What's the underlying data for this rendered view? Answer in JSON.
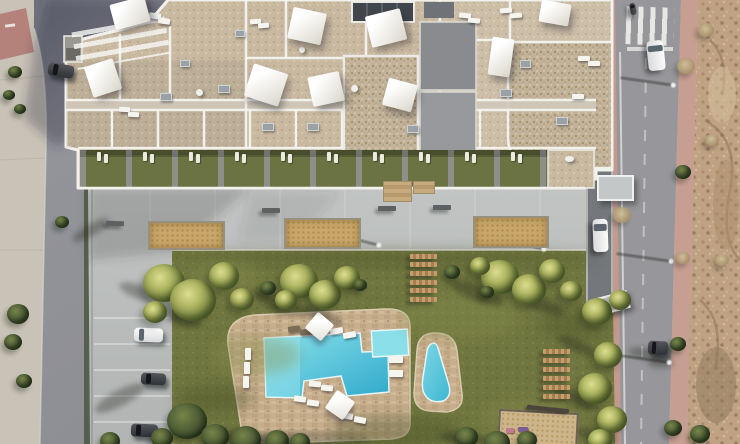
{
  "scene": {
    "subject": "aerial-top-down-render-of-residential-complex-with-roof-terraces-pool-and-garden",
    "palette": {
      "pavement": "#c9c3b7",
      "street_asphalt": "#8d8e94",
      "road_asphalt": "#97979b",
      "esplanade": "#bcbfbe",
      "lawn": "#70763f",
      "roof_gravel": "#c9b9a1",
      "pool_deck_stone": "#c7ae8d",
      "water_deep": "#2fa9cb",
      "water_light": "#8ce2ec",
      "sidewalk_pink": "#c49a8e",
      "dirt_lot": "#bfa284",
      "parapet_white": "#f2f1ec",
      "garden_green": "#6c7342",
      "driveway_gray": "#74777b",
      "sand": "#c8a76c",
      "wood": "#a67f4e",
      "hedge": "#55614a",
      "shade_sail_white": "#ffffff"
    }
  },
  "names": {
    "sail": "shade-sail",
    "umbrella": "parasol",
    "lounger_w": "sun-lounger",
    "lounger_vw": "sun-lounger",
    "lounger_d": "sun-lounger-dark",
    "lounger_v": "garden-lounger",
    "tree_palm": "palm-tree",
    "tree_bush": "shrub",
    "tree_dry": "dry-shrub",
    "shadow": "cast-shadow",
    "shline": "lamp-post-shadow",
    "bench": "bench",
    "sandbox": "planter-sandbox",
    "plank": "wooden-step-plank",
    "car_w": "white-car",
    "car_d": "dark-car",
    "table": "terrace-table",
    "ac": "ac-unit",
    "mat": "entrance-mat",
    "canopy": "entrance-canopy",
    "xwalk_h": "pedestrian-crossing",
    "xwalk_v": "pedestrian-crossing",
    "patch_l": "grass-light-patch",
    "patch_d": "grass-dark-patch",
    "playpit": "playground-sandpit",
    "beam": "playground-beam",
    "playitem_pink": "play-equipment",
    "playitem_purple": "play-equipment"
  },
  "objects": {
    "patch_d": [
      [
        330,
        415,
        130,
        35,
        0
      ],
      [
        175,
        385,
        80,
        28,
        0
      ],
      [
        540,
        310,
        70,
        30,
        0
      ],
      [
        180,
        250,
        420,
        16,
        0
      ]
    ],
    "patch_l": [
      [
        210,
        335,
        90,
        40,
        0
      ],
      [
        400,
        295,
        120,
        45,
        0
      ],
      [
        480,
        400,
        90,
        35,
        0
      ],
      [
        190,
        260,
        70,
        30,
        0
      ]
    ],
    "shadow": [
      [
        118,
        286,
        48,
        14,
        20
      ],
      [
        150,
        308,
        52,
        15,
        20
      ],
      [
        250,
        295,
        58,
        16,
        22
      ],
      [
        300,
        310,
        44,
        13,
        22
      ],
      [
        448,
        285,
        58,
        16,
        22
      ],
      [
        520,
        298,
        46,
        14,
        22
      ],
      [
        556,
        340,
        42,
        12,
        24
      ],
      [
        552,
        392,
        46,
        13,
        24
      ],
      [
        70,
        224,
        42,
        12,
        -30
      ],
      [
        92,
        390,
        56,
        16,
        -28
      ],
      [
        628,
        348,
        40,
        12,
        10
      ],
      [
        214,
        430,
        50,
        14,
        5
      ],
      [
        440,
        432,
        46,
        12,
        5
      ],
      [
        250,
        436,
        60,
        14,
        3
      ],
      [
        575,
        430,
        44,
        12,
        15
      ],
      [
        648,
        358,
        26,
        10,
        0
      ]
    ],
    "shline": [
      [
        332,
        238,
        48,
        3,
        14
      ],
      [
        497,
        242,
        48,
        3,
        14
      ],
      [
        620,
        80,
        54,
        3,
        8
      ],
      [
        616,
        256,
        56,
        3,
        8
      ],
      [
        612,
        357,
        58,
        3,
        8
      ]
    ],
    "sandbox": [
      [
        148,
        221,
        73,
        25,
        0
      ],
      [
        284,
        218,
        73,
        27,
        0
      ],
      [
        473,
        216,
        72,
        28,
        0
      ]
    ],
    "mat": [
      [
        383,
        181,
        27,
        19,
        0
      ],
      [
        413,
        181,
        20,
        11,
        0
      ]
    ],
    "bench": [
      [
        106,
        221,
        18,
        5,
        2
      ],
      [
        262,
        208,
        18,
        5,
        0
      ],
      [
        378,
        206,
        18,
        5,
        0
      ],
      [
        433,
        205,
        18,
        5,
        0
      ]
    ],
    "plank": [
      [
        410,
        254,
        27,
        5,
        0
      ],
      [
        410,
        262,
        27,
        5,
        0
      ],
      [
        410,
        271,
        27,
        5,
        0
      ],
      [
        410,
        280,
        27,
        5,
        0
      ],
      [
        410,
        288,
        27,
        5,
        0
      ],
      [
        410,
        297,
        27,
        5,
        0
      ],
      [
        543,
        349,
        27,
        5,
        0
      ],
      [
        543,
        358,
        27,
        5,
        0
      ],
      [
        543,
        367,
        27,
        5,
        0
      ],
      [
        543,
        376,
        27,
        5,
        0
      ],
      [
        543,
        385,
        27,
        5,
        0
      ],
      [
        543,
        394,
        27,
        5,
        0
      ]
    ],
    "playpit": [
      [
        498,
        411,
        76,
        33,
        3
      ]
    ],
    "beam": [
      [
        527,
        407,
        42,
        4,
        6
      ]
    ],
    "playitem_pink": [
      [
        506,
        428,
        8,
        5,
        0
      ]
    ],
    "playitem_purple": [
      [
        518,
        427,
        10,
        5,
        0
      ]
    ],
    "xwalk_h": [
      [
        74,
        24,
        94,
        38,
        -10
      ]
    ],
    "xwalk_v": [
      [
        626,
        7,
        48,
        38,
        2
      ]
    ],
    "car_w": [
      [
        134,
        328,
        29,
        14,
        2
      ],
      [
        584,
        228,
        33,
        15,
        88
      ],
      [
        641,
        47,
        30,
        17,
        84
      ]
    ],
    "car_d": [
      [
        141,
        373,
        25,
        12,
        3
      ],
      [
        131,
        424,
        27,
        13,
        2
      ],
      [
        48,
        64,
        26,
        13,
        10
      ],
      [
        648,
        341,
        20,
        14,
        3
      ],
      [
        627,
        6,
        12,
        6,
        80
      ]
    ],
    "canopy": [
      [
        597,
        175,
        33,
        22,
        0
      ],
      [
        597,
        294,
        28,
        14,
        -15
      ]
    ],
    "lounger_v": [
      [
        97,
        152,
        4,
        9,
        0
      ],
      [
        104,
        154,
        4,
        9,
        0
      ],
      [
        143,
        152,
        4,
        9,
        0
      ],
      [
        150,
        154,
        4,
        9,
        0
      ],
      [
        189,
        152,
        4,
        9,
        0
      ],
      [
        196,
        154,
        4,
        9,
        0
      ],
      [
        235,
        152,
        4,
        9,
        0
      ],
      [
        242,
        154,
        4,
        9,
        0
      ],
      [
        281,
        152,
        4,
        9,
        0
      ],
      [
        288,
        154,
        4,
        9,
        0
      ],
      [
        327,
        152,
        4,
        9,
        0
      ],
      [
        334,
        154,
        4,
        9,
        0
      ],
      [
        373,
        152,
        4,
        9,
        0
      ],
      [
        380,
        154,
        4,
        9,
        0
      ],
      [
        419,
        152,
        4,
        9,
        0
      ],
      [
        426,
        154,
        4,
        9,
        0
      ],
      [
        465,
        152,
        4,
        9,
        0
      ],
      [
        472,
        154,
        4,
        9,
        0
      ],
      [
        511,
        152,
        4,
        9,
        0
      ],
      [
        518,
        154,
        4,
        9,
        0
      ]
    ],
    "lounger_w": [
      [
        149,
        13,
        12,
        6,
        8
      ],
      [
        158,
        18,
        12,
        6,
        8
      ],
      [
        250,
        19,
        11,
        5,
        -5
      ],
      [
        258,
        23,
        11,
        5,
        -5
      ],
      [
        459,
        13,
        12,
        5,
        6
      ],
      [
        468,
        18,
        12,
        5,
        6
      ],
      [
        119,
        107,
        11,
        5,
        3
      ],
      [
        128,
        112,
        11,
        5,
        3
      ],
      [
        572,
        94,
        12,
        5,
        0
      ],
      [
        500,
        8,
        12,
        5,
        -4
      ],
      [
        510,
        13,
        12,
        5,
        -4
      ],
      [
        578,
        56,
        12,
        5,
        0
      ],
      [
        588,
        61,
        12,
        5,
        0
      ],
      [
        330,
        328,
        13,
        6,
        -10
      ],
      [
        343,
        332,
        13,
        6,
        -10
      ],
      [
        389,
        356,
        14,
        7,
        0
      ],
      [
        389,
        370,
        14,
        7,
        0
      ],
      [
        309,
        381,
        12,
        6,
        5
      ],
      [
        321,
        385,
        12,
        6,
        5
      ],
      [
        294,
        396,
        12,
        6,
        8
      ],
      [
        307,
        400,
        12,
        6,
        8
      ],
      [
        341,
        413,
        12,
        6,
        10
      ],
      [
        354,
        417,
        12,
        6,
        10
      ]
    ],
    "lounger_vw": [
      [
        245,
        348,
        6,
        12,
        0
      ],
      [
        244,
        362,
        6,
        12,
        0
      ],
      [
        243,
        376,
        6,
        12,
        0
      ]
    ],
    "lounger_d": [
      [
        288,
        326,
        12,
        6,
        -8
      ],
      [
        300,
        329,
        12,
        6,
        -8
      ]
    ],
    "table": [
      [
        196,
        89,
        7,
        7,
        0
      ],
      [
        351,
        85,
        7,
        7,
        0
      ],
      [
        565,
        156,
        9,
        6,
        0
      ],
      [
        299,
        47,
        6,
        6,
        0
      ]
    ],
    "ac": [
      [
        160,
        93,
        10,
        6,
        0
      ],
      [
        218,
        85,
        10,
        6,
        0
      ],
      [
        262,
        123,
        10,
        6,
        0
      ],
      [
        307,
        123,
        10,
        6,
        0
      ],
      [
        407,
        125,
        10,
        6,
        0
      ],
      [
        500,
        89,
        10,
        6,
        0
      ],
      [
        556,
        117,
        10,
        6,
        0
      ],
      [
        180,
        60,
        8,
        5,
        0
      ],
      [
        235,
        30,
        8,
        5,
        0
      ],
      [
        520,
        60,
        9,
        6,
        0
      ]
    ],
    "umbrella": [
      [
        309,
        316,
        21,
        21,
        40
      ],
      [
        329,
        394,
        22,
        22,
        35
      ]
    ],
    "sail": [
      [
        112,
        0,
        36,
        26,
        -15
      ],
      [
        88,
        62,
        30,
        32,
        -18
      ],
      [
        290,
        10,
        34,
        32,
        12
      ],
      [
        368,
        12,
        36,
        32,
        -14
      ],
      [
        248,
        68,
        36,
        34,
        18
      ],
      [
        310,
        74,
        32,
        30,
        -12
      ],
      [
        385,
        81,
        30,
        28,
        15
      ],
      [
        540,
        2,
        30,
        22,
        10
      ],
      [
        490,
        38,
        22,
        38,
        8
      ]
    ],
    "tree_dry": [
      [
        677,
        58,
        18,
        16,
        0
      ],
      [
        698,
        23,
        16,
        14,
        0
      ],
      [
        705,
        134,
        14,
        12,
        0
      ],
      [
        715,
        254,
        14,
        12,
        0
      ],
      [
        613,
        207,
        18,
        16,
        0
      ],
      [
        676,
        252,
        14,
        12,
        0
      ]
    ],
    "tree_palm": [
      [
        143,
        264,
        42,
        38,
        0
      ],
      [
        170,
        279,
        46,
        42,
        0
      ],
      [
        209,
        262,
        30,
        28,
        0
      ],
      [
        230,
        288,
        24,
        22,
        0
      ],
      [
        143,
        301,
        24,
        22,
        0
      ],
      [
        280,
        264,
        38,
        34,
        0
      ],
      [
        309,
        280,
        32,
        29,
        0
      ],
      [
        334,
        266,
        26,
        24,
        0
      ],
      [
        275,
        290,
        22,
        20,
        0
      ],
      [
        481,
        260,
        38,
        34,
        0
      ],
      [
        512,
        274,
        34,
        31,
        0
      ],
      [
        539,
        259,
        26,
        24,
        0
      ],
      [
        470,
        257,
        20,
        18,
        0
      ],
      [
        560,
        281,
        22,
        20,
        0
      ],
      [
        582,
        298,
        30,
        27,
        0
      ],
      [
        594,
        342,
        28,
        26,
        0
      ],
      [
        578,
        373,
        34,
        31,
        0
      ],
      [
        597,
        406,
        30,
        27,
        0
      ],
      [
        588,
        429,
        24,
        22,
        0
      ],
      [
        609,
        290,
        22,
        20,
        0
      ]
    ],
    "tree_bush": [
      [
        167,
        403,
        40,
        36,
        0
      ],
      [
        201,
        424,
        28,
        25,
        0
      ],
      [
        231,
        426,
        30,
        27,
        0
      ],
      [
        265,
        430,
        24,
        22,
        0
      ],
      [
        151,
        428,
        22,
        20,
        0
      ],
      [
        100,
        432,
        20,
        18,
        0
      ],
      [
        290,
        433,
        20,
        18,
        0
      ],
      [
        456,
        427,
        22,
        20,
        0
      ],
      [
        484,
        431,
        26,
        23,
        0
      ],
      [
        517,
        431,
        20,
        18,
        0
      ],
      [
        260,
        281,
        16,
        14,
        0
      ],
      [
        353,
        279,
        14,
        12,
        0
      ],
      [
        444,
        265,
        16,
        14,
        0
      ],
      [
        480,
        286,
        14,
        12,
        0
      ],
      [
        7,
        304,
        22,
        20,
        0
      ],
      [
        4,
        334,
        18,
        16,
        0
      ],
      [
        16,
        374,
        16,
        14,
        0
      ],
      [
        8,
        66,
        14,
        12,
        0
      ],
      [
        3,
        90,
        12,
        10,
        0
      ],
      [
        14,
        104,
        12,
        10,
        0
      ],
      [
        55,
        216,
        14,
        12,
        0
      ],
      [
        675,
        165,
        16,
        14,
        0
      ],
      [
        670,
        337,
        16,
        14,
        0
      ],
      [
        664,
        420,
        18,
        16,
        0
      ],
      [
        690,
        425,
        20,
        18,
        0
      ]
    ]
  }
}
